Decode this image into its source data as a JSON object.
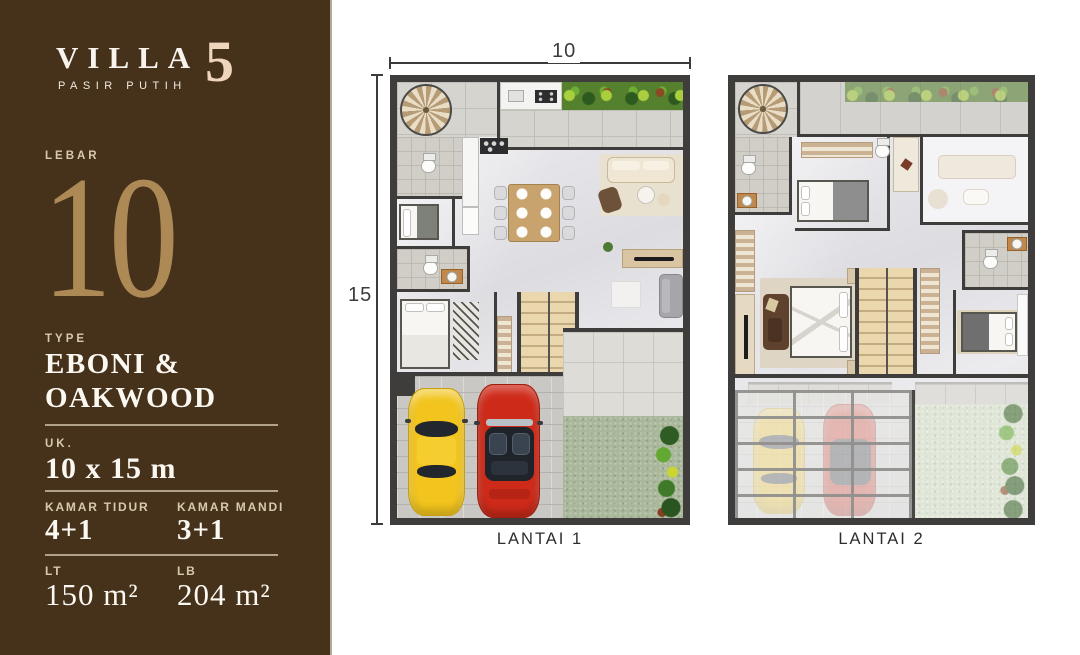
{
  "sidebar": {
    "brand": {
      "title": "VILLA",
      "number": "5",
      "subtitle": "PASIR PUTIH"
    },
    "lebar": {
      "label": "LEBAR",
      "value": "10"
    },
    "type": {
      "label": "TYPE",
      "line1": "EBONI &",
      "line2": "OAKWOOD"
    },
    "uk": {
      "label": "UK.",
      "value": "10 x 15 m"
    },
    "kamar_tidur": {
      "label": "KAMAR TIDUR",
      "value": "4+1"
    },
    "kamar_mandi": {
      "label": "KAMAR MANDI",
      "value": "3+1"
    },
    "lt": {
      "label": "LT",
      "value": "150 m²"
    },
    "lb": {
      "label": "LB",
      "value": "204 m²"
    }
  },
  "floorplans": {
    "plan1": {
      "label": "LANTAI 1",
      "dim_width": "10",
      "dim_height": "15"
    },
    "plan2": {
      "label": "LANTAI 2"
    }
  },
  "colors": {
    "sidebar_brown": "#46311b",
    "gold_numeral": "#ad8a55",
    "cream_accent": "#eed5bb",
    "label_cream": "#d9c8ae",
    "wall_dark": "#3e3d3b",
    "lawn_green": "#a9b79a",
    "garden_green": "#55812f",
    "car_yellow": "#f2c41d",
    "car_red": "#ce2a19",
    "wood": "#c9a36e"
  }
}
